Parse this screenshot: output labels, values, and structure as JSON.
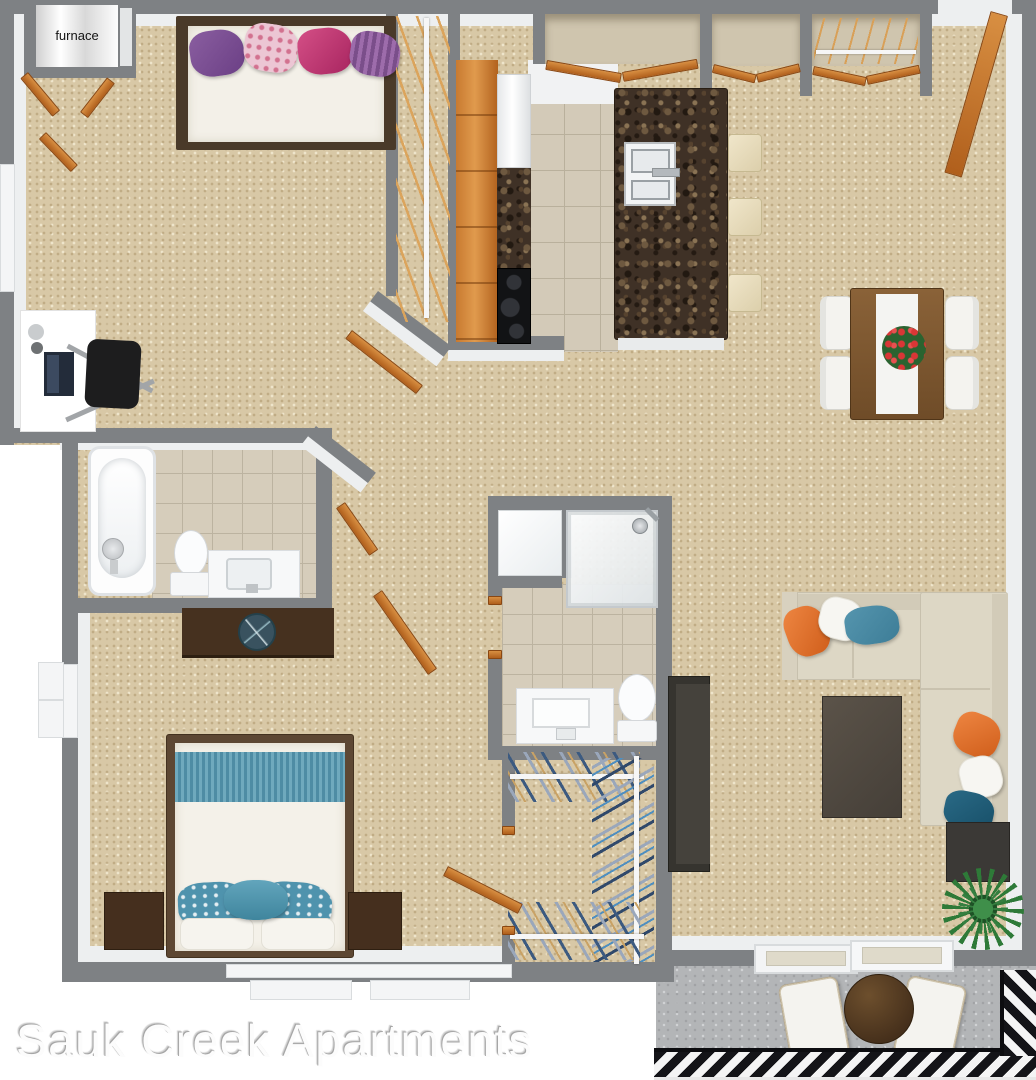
{
  "labels": {
    "watermark": "Sauk Creek Apartments",
    "furnace": "furnace"
  },
  "palette": {
    "wall_gray": "#7e8184",
    "wall_face_white": "#edeff0",
    "carpet_beige": "#d8c8a6",
    "tile_beige": "#d3cab8",
    "balcony_concrete": "#b3b5b7",
    "wood_door_orange": "#c87a30",
    "counter_marble_brown": "#3f3126",
    "sofa_cream": "#ddd7c5",
    "accent_orange": "#e07030",
    "accent_teal": "#4f93ad",
    "bed_blue": "#4e8ca4",
    "dining_wood": "#7a5a36",
    "dark_furniture": "#3c3a37",
    "watermark_text": "#fcfcfc"
  },
  "features": [
    "furnace-closet",
    "bed",
    "pillows",
    "desk",
    "office-chair",
    "hanger-closet",
    "kitchen-cabinets",
    "refrigerator",
    "stove",
    "kitchen-island",
    "double-sink",
    "bar-stools",
    "pantry",
    "entry-closets",
    "entry-door",
    "dining-table",
    "dining-chairs",
    "bathtub",
    "toilet",
    "vanity",
    "dresser",
    "shower",
    "linen-closet",
    "walk-in-closet",
    "sectional-sofa",
    "coffee-table",
    "tv-stand",
    "end-table",
    "plant",
    "balcony-table",
    "balcony-chairs",
    "sliding-glass-door",
    "railing"
  ]
}
